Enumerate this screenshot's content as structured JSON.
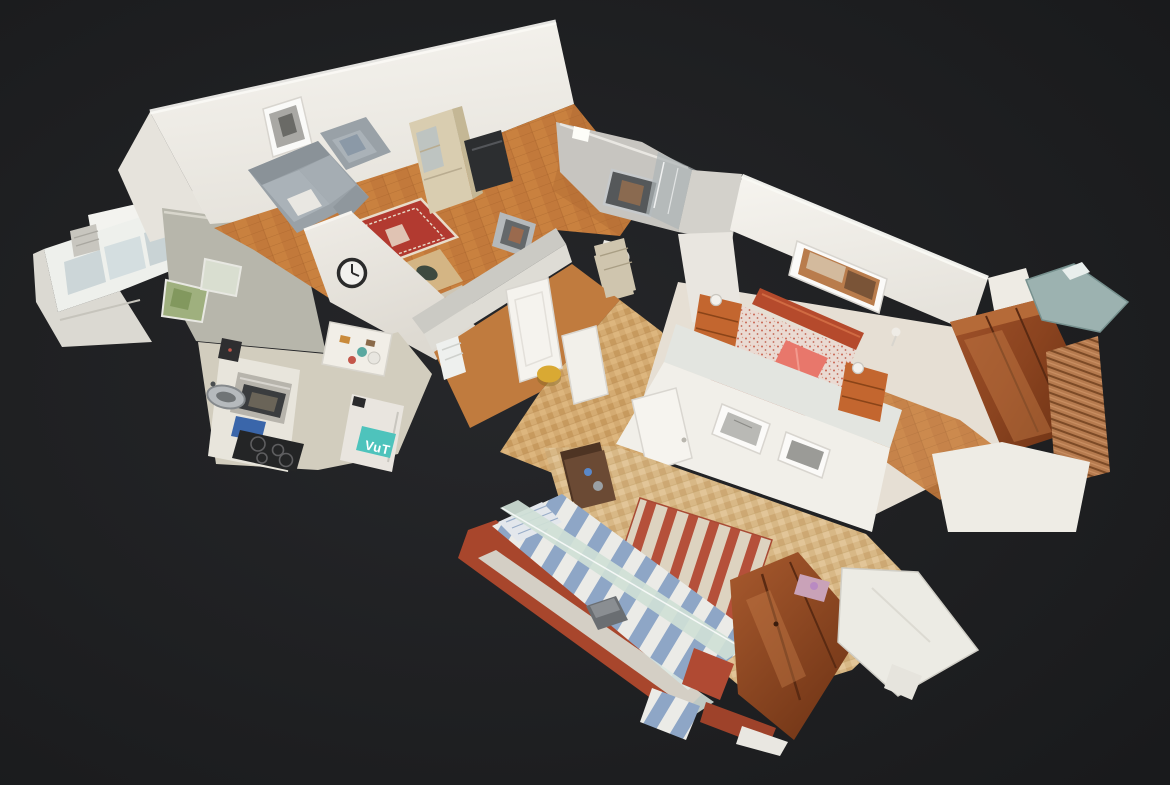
{
  "scene": {
    "view_type": "3d-dollhouse-cutaway",
    "description": "Overhead cutaway 3D scan (dollhouse view) of a furnished apartment floating on a dark background, rotated diagonally. Rooms left to right: glazed balcony, kitchen, living room, bathroom core, hallway, main bedroom with red double bed and cherry wardrobe, and a second bedroom with a blue-and-white striped bed.",
    "labels": {
      "fridge_magnet": "VuT"
    },
    "rooms": [
      {
        "name": "glazed-balcony",
        "contents": [
          "white window band",
          "railing",
          "vent grille"
        ]
      },
      {
        "name": "kitchen",
        "contents": [
          "counter",
          "oven",
          "black ceramic hob",
          "blue cutting board",
          "steel sink",
          "fridge with teal magnet",
          "breakfast table"
        ]
      },
      {
        "name": "living-room",
        "contents": [
          "grey sofa",
          "grey armchair",
          "red patterned rug",
          "coffee table",
          "oak display cabinet",
          "tv",
          "wall clock",
          "framed picture"
        ]
      },
      {
        "name": "bathroom",
        "contents": [
          "marble wall",
          "dark mirror",
          "shower glass",
          "framed mirror",
          "toilet",
          "drawer cabinet"
        ]
      },
      {
        "name": "hallway",
        "contents": [
          "parquet floor",
          "white doors",
          "yellow stool",
          "white radiator"
        ]
      },
      {
        "name": "main-bedroom",
        "contents": [
          "red double bed",
          "pink pillow",
          "orange nightstands",
          "white wall lamps",
          "framed landscape picture",
          "cherry wardrobe",
          "copper roller blind"
        ]
      },
      {
        "name": "second-bedroom",
        "contents": [
          "blue-white striped bed",
          "red bed frame",
          "glass side rail",
          "red striped rug",
          "dark walnut nightstand",
          "cherry wardrobe",
          "two framed prints",
          "white dresser"
        ]
      }
    ],
    "palette": {
      "bg": "#1d1e20",
      "bgGlow": "#27282b",
      "wall": "#f2f0ea",
      "wallShade": "#e7e4dd",
      "wallDim": "#dedcd5",
      "cutTop": "#cbcac4",
      "ridge": "#fbfaf6",
      "woodFloor": "#c9813f",
      "woodDark": "#b06a33",
      "parquetLight": "#d4ab72",
      "mosaicFloor": "#d8b886",
      "kitchenFloor": "#d2cdbe",
      "counter": "#e8e5dc",
      "greenWall": "#b7b6ab",
      "windowPane": "#ccd6d8",
      "greenery": "#9fb07e",
      "rugRed": "#b23a30",
      "rugCream": "#e8dcca",
      "sofaGray": "#99a1a7",
      "sofaLight": "#aab2b8",
      "shelfWood": "#d9cdb0",
      "tvDark": "#2c2e30",
      "marble": "#c7c5c0",
      "mirrorDark": "#55585a",
      "glassPane": "#aeb5b7",
      "doorWhite": "#f5f3ee",
      "stoolYellow": "#d9a933",
      "bedSpread": "#eadad2",
      "speckleRed": "#c4543e",
      "bedRed": "#b54a2c",
      "pillowPink": "#e8776b",
      "nightstandWood": "#c3662f",
      "wardrobeLight": "#a0522a",
      "wardrobeDark": "#6e3315",
      "woodShine": "#c57c46",
      "stripeBlue": "#8ea6c6",
      "stripeWhite": "#ebebe7",
      "frameRed": "#a8462c",
      "glassRail": "#cfe0d6",
      "rugStripeRed": "#b5503a",
      "rugStripeCream": "#ddd3c0",
      "walnut": "#6b4a34",
      "ovenSteel": "#b7b4ac",
      "cooktopBlack": "#242526",
      "blueBoard": "#3a66aa",
      "tealMagnet": "#4ec3bc",
      "tealMetal": "#9cb2b0",
      "slabWhite": "#ecebe4",
      "clockDark": "#2b2b2b"
    }
  }
}
